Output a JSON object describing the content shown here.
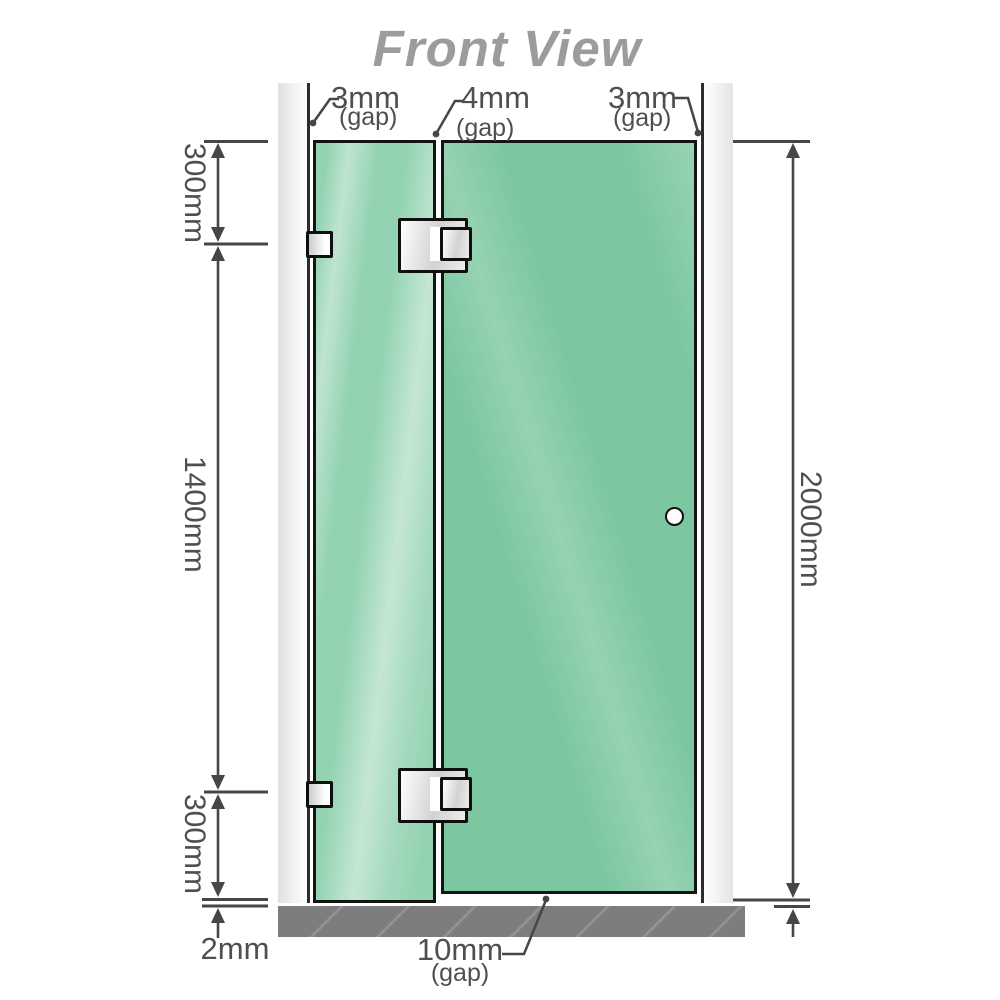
{
  "title": "Front View",
  "dimensions": {
    "top_gaps": [
      {
        "value": "3mm",
        "sub": "(gap)"
      },
      {
        "value": "4mm",
        "sub": "(gap)"
      },
      {
        "value": "3mm",
        "sub": "(gap)"
      }
    ],
    "left": [
      {
        "value": "300mm"
      },
      {
        "value": "1400mm"
      },
      {
        "value": "300mm"
      }
    ],
    "right_total": "2000mm",
    "floor_clearance": "2mm",
    "bottom_gap": {
      "value": "10mm",
      "sub": "(gap)"
    }
  },
  "colors": {
    "title_gray": "#9c9c9c",
    "dimension_gray": "#4f4f4f",
    "line_gray": "#464646",
    "glass_fixed_green": "#94d3b2",
    "glass_door_green": "#7cc7a0",
    "glass_border": "#141414",
    "wall_channel": "#e8e8e8",
    "floor_gray": "#7d7d7d",
    "hardware_silver": "#e6e6e6",
    "logo_red": "#7a1b2e"
  }
}
